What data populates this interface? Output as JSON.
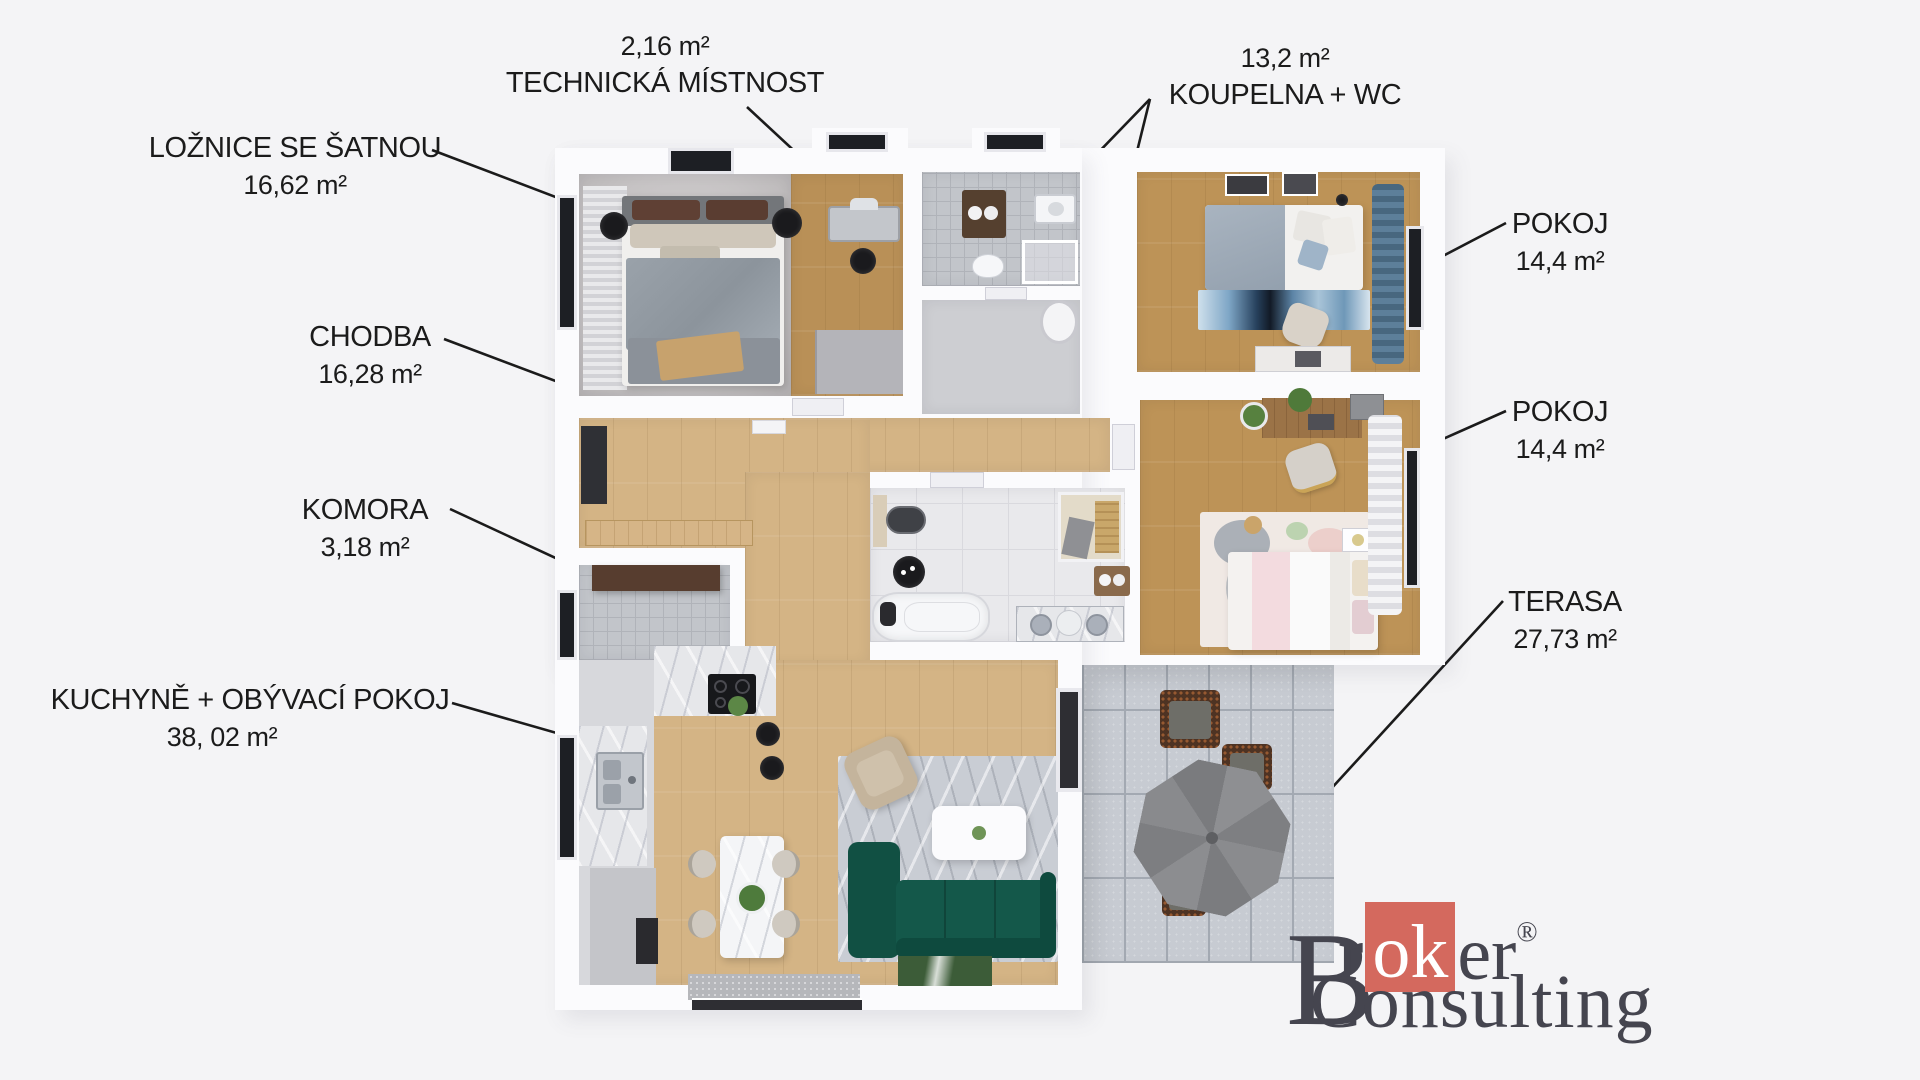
{
  "labels": [
    {
      "id": "loznice",
      "name": "LOŽNICE SE ŠATNOU",
      "area": "16,62 m²"
    },
    {
      "id": "technicka",
      "name": "TECHNICKÁ MÍSTNOST",
      "area": "2,16 m²"
    },
    {
      "id": "koupelna",
      "name": "KOUPELNA + WC",
      "area": "13,2 m²"
    },
    {
      "id": "chodba",
      "name": "CHODBA",
      "area": "16,28 m²"
    },
    {
      "id": "komora",
      "name": "KOMORA",
      "area": "3,18 m²"
    },
    {
      "id": "kuchyne",
      "name": "KUCHYNĚ + OBÝVACÍ POKOJ",
      "area": "38, 02 m²"
    },
    {
      "id": "pokoj1",
      "name": "POKOJ",
      "area": "14,4 m²"
    },
    {
      "id": "pokoj2",
      "name": "POKOJ",
      "area": "14,4 m²"
    },
    {
      "id": "terasa",
      "name": "TERASA",
      "area": "27,73 m²"
    }
  ],
  "logo": {
    "b": "B",
    "r": "r",
    "ok": "ok",
    "er": "er",
    "reg": "®",
    "consulting": "Consulting"
  },
  "colors": {
    "bg": "#f4f4f6",
    "wall": "#fbfbfd",
    "label": "#1b1b1b",
    "wood-hall": "#d4b485",
    "wood-warm": "#bd9357",
    "wood-dress": "#b99057",
    "tile": "#e9e9ec",
    "paver": "#c7cbd2",
    "sofa": "#14584a",
    "accent": "#d4695e",
    "logotext": "#45454f"
  }
}
